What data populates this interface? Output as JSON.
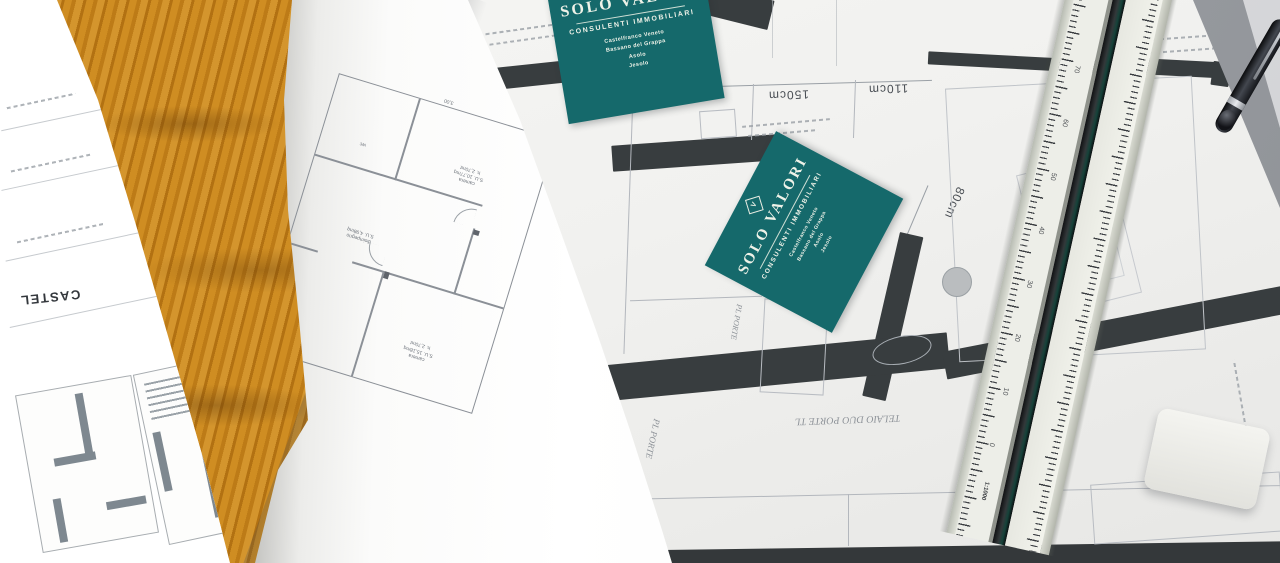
{
  "cards": {
    "brand": "SOLO VALORI",
    "tagline": "CONSULENTI IMMOBILIARI",
    "locations": [
      "Castelfranco Veneto",
      "Bassano del Grappa",
      "Asolo",
      "Jesolo"
    ],
    "logo_letter": "V",
    "teal_hex": "#15696b"
  },
  "blueprint": {
    "dims_top": [
      "110cm",
      "150cm",
      "110cm"
    ],
    "dim_side": "80cm",
    "note_vertical_1": "PL PORTE",
    "note_vertical_2": "PL PORTE",
    "note_upside_down": "TELAIO DUO PORTE TL",
    "wall_hex": "#383d3f"
  },
  "plan_page": {
    "room1_name": "camera",
    "room1_area": "S.U. 15,18mq",
    "room1_h": "h. 2,70mt",
    "room2_name": "disimpegno",
    "room2_area": "S.U. 4,98mq",
    "room3_name": "camera",
    "room3_area": "S.U. 10,77mq",
    "room3_h": "h. 2,70mt",
    "room4_name": "wc",
    "dim_bottom": "3,00"
  },
  "left_roll": {
    "title": "CASTEL"
  },
  "ruler": {
    "scale": "1:1000",
    "ticks": [
      "0",
      "10",
      "20",
      "30",
      "40",
      "50",
      "60",
      "70"
    ]
  },
  "palette": {
    "wood": "#c9861e",
    "paper": "#f6f6f4",
    "wall": "#383d3f",
    "card": "#15696b"
  }
}
